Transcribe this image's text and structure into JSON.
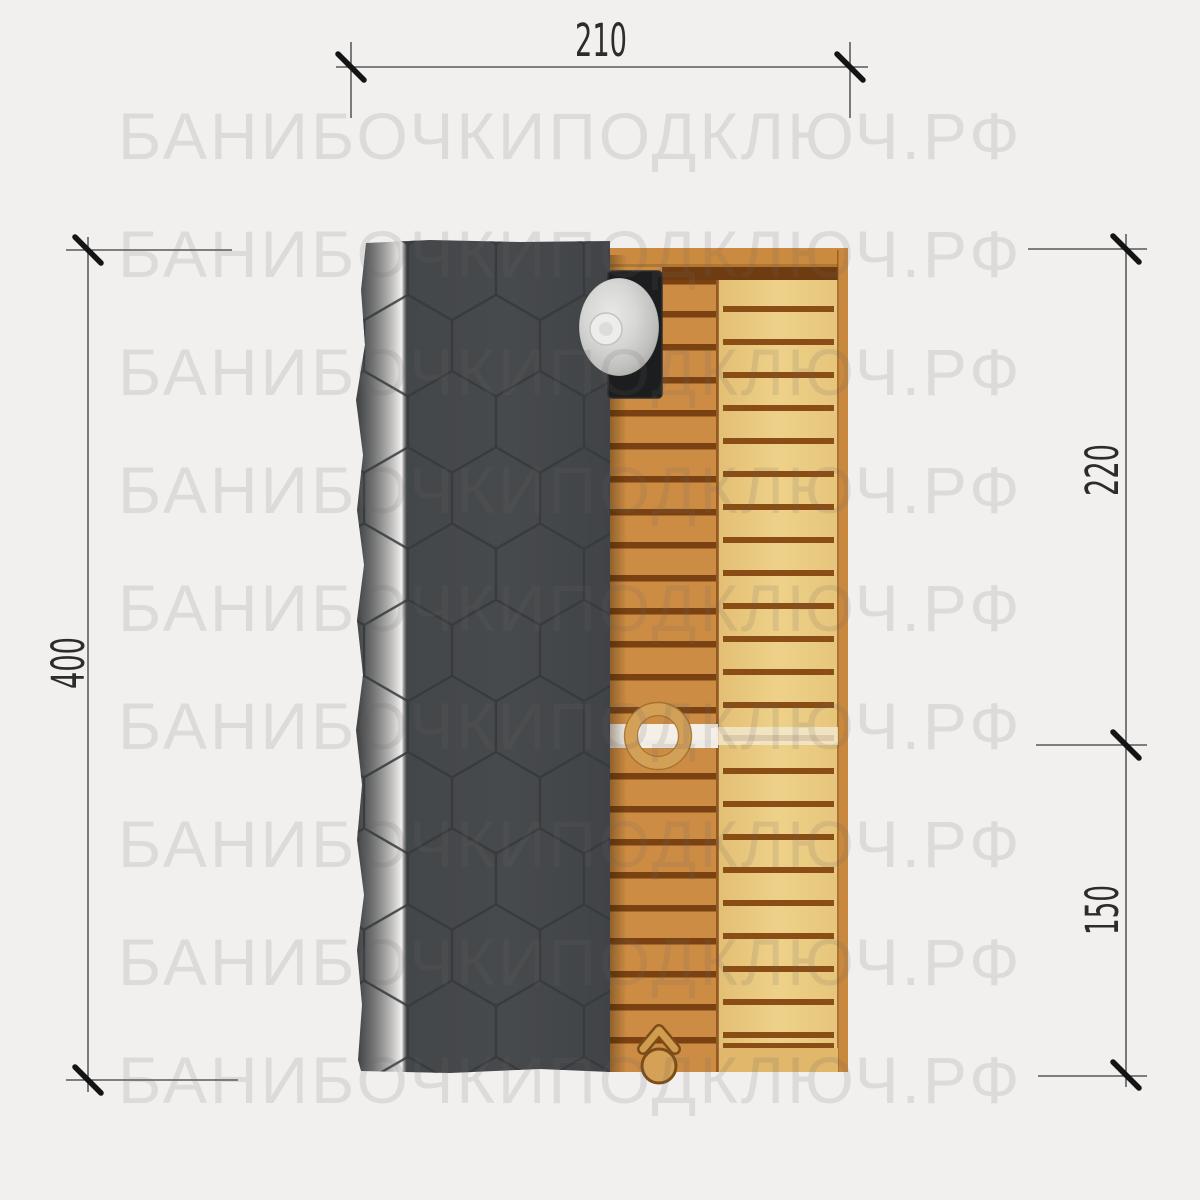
{
  "watermark": {
    "text": "БАНИБОЧКИПОДКЛЮЧ.РФ",
    "rows": 9
  },
  "dimensions": {
    "top_width": "210",
    "left_length": "400",
    "right_upper": "220",
    "right_lower": "150"
  },
  "drawing": {
    "type": "plan-top-view",
    "subject": "barrel-sauna roof and entrance deck",
    "colors": {
      "background": "#f1f0ee",
      "roof_shingles": "#45484b",
      "shingle_lines": "#35393c",
      "chimney_base": "#1c1d1e",
      "chimney_cap": "#cfcfcd",
      "door_planks": "#cd8c43",
      "deck_planks": "#eccd85",
      "plank_gap_dark": "#7a4212",
      "plank_gap_deck": "#8a4d15",
      "frame_wood": "#ca8a40",
      "threshold_board": "#f6f3ee",
      "dimension_lines": "#3b3b3b",
      "dimension_text": "#2c2c2c",
      "watermark_text": "rgba(105,102,98,0.15)"
    }
  }
}
